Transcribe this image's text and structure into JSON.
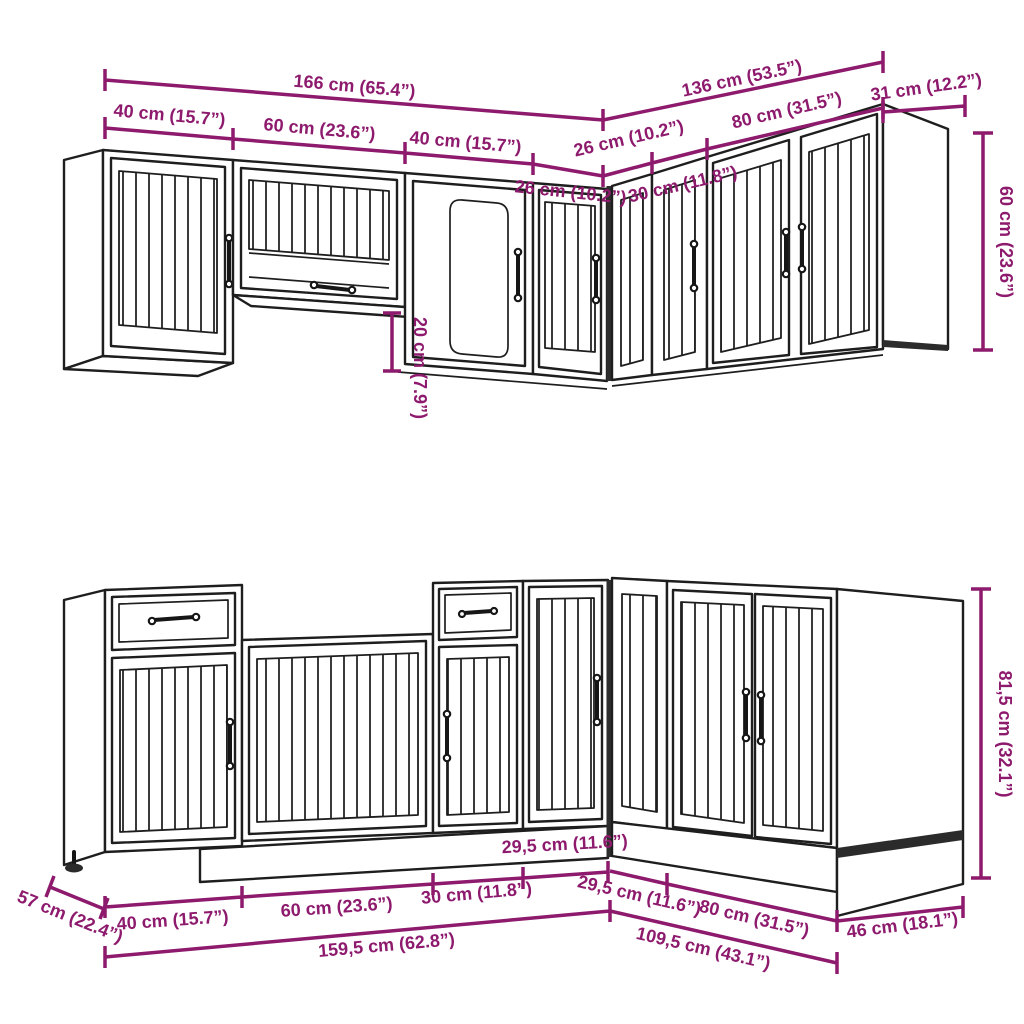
{
  "figure": {
    "kind": "kitchen-cabinet-set-dimension-diagram",
    "background": "#ffffff",
    "accent_color": "#8d1a6d",
    "line_color": "#1e1e1e",
    "shadow_color": "#2b2b2b"
  },
  "top": {
    "name": "wall-cabinet-assembly",
    "dims": {
      "total_left": "166 cm (65.4”)",
      "seg_40_a": "40 cm (15.7”)",
      "seg_60": "60 cm (23.6”)",
      "seg_40_b": "40 cm (15.7”)",
      "seg_26_left": "26 cm (10.2”)",
      "seg_26_right": "26 cm (10.2”)",
      "seg_30": "30 cm (11.8”)",
      "seg_80": "80 cm (31.5”)",
      "total_right": "136 cm (53.5”)",
      "depth_31": "31 cm (12.2”)",
      "height_60": "60 cm (23.6”)",
      "gap_20": "20 cm (7.9”)"
    }
  },
  "bottom": {
    "name": "base-cabinet-assembly",
    "dims": {
      "depth_57": "57 cm (22.4”)",
      "seg_40": "40 cm (15.7”)",
      "seg_60": "60 cm (23.6”)",
      "seg_30": "30 cm (11.8”)",
      "seg_295_left": "29,5 cm (11.6”)",
      "total_left": "159,5 cm (62.8”)",
      "seg_295_right": "29,5 cm (11.6”)",
      "seg_80": "80 cm (31.5”)",
      "depth_46": "46 cm (18.1”)",
      "total_right": "109,5 cm (43.1”)",
      "height_815": "81,5 cm (32.1”)"
    }
  }
}
